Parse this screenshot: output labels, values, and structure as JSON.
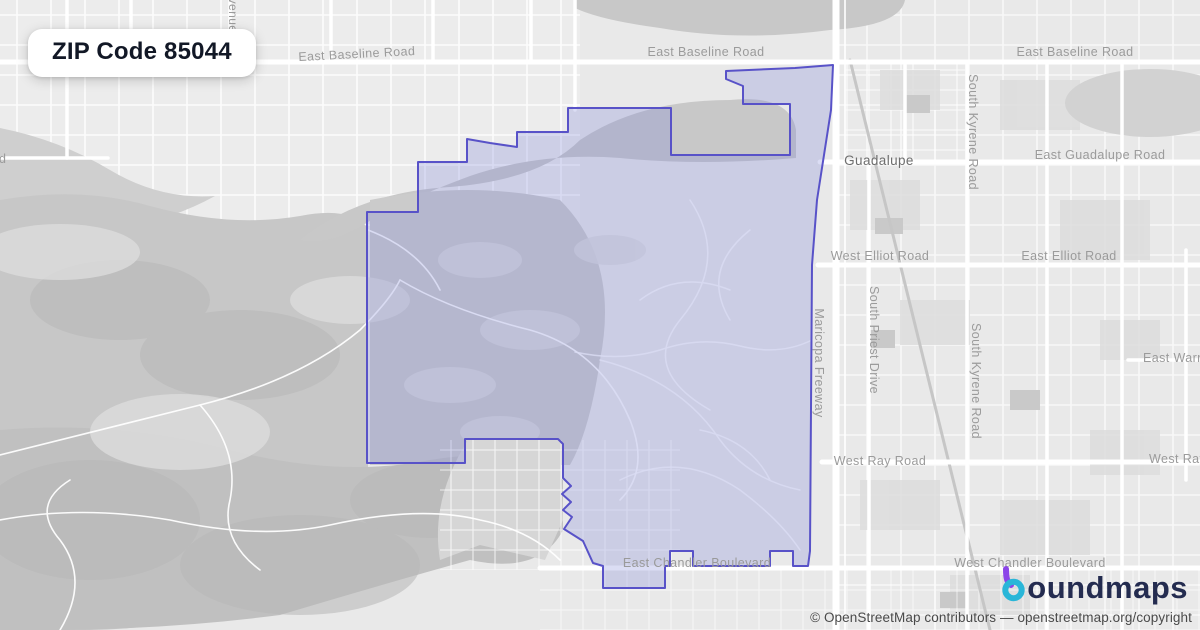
{
  "badge": {
    "title": "ZIP Code 85044"
  },
  "map": {
    "labels": [
      {
        "name": "road-label-east-baseline-road-west",
        "text": "East Baseline Road",
        "x": 357,
        "y": 58,
        "rotate": -3,
        "size": 12.5,
        "color": "#9b9b9b",
        "anchor": "middle"
      },
      {
        "name": "road-label-east-baseline-road-mid",
        "text": "East Baseline Road",
        "x": 706,
        "y": 56,
        "rotate": 0,
        "size": 12.5,
        "color": "#9b9b9b",
        "anchor": "middle"
      },
      {
        "name": "road-label-east-baseline-road-east",
        "text": "East Baseline Road",
        "x": 1075,
        "y": 56,
        "rotate": 0,
        "size": 12.5,
        "color": "#9b9b9b",
        "anchor": "middle"
      },
      {
        "name": "place-label-guadalupe",
        "text": "Guadalupe",
        "x": 879,
        "y": 165,
        "rotate": 0,
        "size": 13.5,
        "color": "#6e6e6e",
        "anchor": "middle"
      },
      {
        "name": "road-label-east-guadalupe-road",
        "text": "East Guadalupe Road",
        "x": 1100,
        "y": 159,
        "rotate": 0,
        "size": 12.5,
        "color": "#9b9b9b",
        "anchor": "middle"
      },
      {
        "name": "road-label-west-elliot-road",
        "text": "West Elliot Road",
        "x": 880,
        "y": 260,
        "rotate": 0,
        "size": 12.5,
        "color": "#9b9b9b",
        "anchor": "middle"
      },
      {
        "name": "road-label-east-elliot-road",
        "text": "East Elliot Road",
        "x": 1069,
        "y": 260,
        "rotate": 0,
        "size": 12.5,
        "color": "#9b9b9b",
        "anchor": "middle"
      },
      {
        "name": "road-label-maricopa-freeway",
        "text": "Maricopa Freeway",
        "x": 815,
        "y": 363,
        "rotate": 90,
        "size": 12.5,
        "color": "#9b9b9b",
        "anchor": "middle"
      },
      {
        "name": "road-label-south-priest-drive",
        "text": "South Priest Drive",
        "x": 870,
        "y": 340,
        "rotate": 90,
        "size": 12.5,
        "color": "#9b9b9b",
        "anchor": "middle"
      },
      {
        "name": "road-label-south-kyrene-road-north",
        "text": "South Kyrene Road",
        "x": 969,
        "y": 132,
        "rotate": 90,
        "size": 12.5,
        "color": "#9b9b9b",
        "anchor": "middle"
      },
      {
        "name": "road-label-south-kyrene-road-south",
        "text": "South Kyrene Road",
        "x": 972,
        "y": 381,
        "rotate": 90,
        "size": 12.5,
        "color": "#9b9b9b",
        "anchor": "middle"
      },
      {
        "name": "road-label-east-warner-clipped",
        "text": "East Warner Road",
        "x": 1143,
        "y": 362,
        "rotate": 0,
        "size": 12.5,
        "color": "#9b9b9b",
        "anchor": "start"
      },
      {
        "name": "road-label-west-ray-road",
        "text": "West Ray Road",
        "x": 880,
        "y": 465,
        "rotate": 0,
        "size": 12.5,
        "color": "#9b9b9b",
        "anchor": "middle"
      },
      {
        "name": "road-label-west-ray-clipped",
        "text": "West Ray Road",
        "x": 1149,
        "y": 463,
        "rotate": 0,
        "size": 12.5,
        "color": "#9b9b9b",
        "anchor": "start"
      },
      {
        "name": "road-label-east-chandler-boulevard",
        "text": "East Chandler Boulevard",
        "x": 697,
        "y": 567,
        "rotate": 0,
        "size": 12.5,
        "color": "#9a9a9a",
        "anchor": "middle"
      },
      {
        "name": "road-label-west-chandler-boulevard",
        "text": "West Chandler Boulevard",
        "x": 1030,
        "y": 567,
        "rotate": 0,
        "size": 12.5,
        "color": "#9b9b9b",
        "anchor": "middle"
      },
      {
        "name": "road-label-avenue-fragment",
        "text": "venue",
        "x": 229,
        "y": 15,
        "rotate": 90,
        "size": 12,
        "color": "#9b9b9b",
        "anchor": "middle"
      },
      {
        "name": "road-label-road-fragment",
        "text": "d",
        "x": -1,
        "y": 163,
        "rotate": 0,
        "size": 12.5,
        "color": "#9b9b9b",
        "anchor": "start"
      }
    ]
  },
  "boundary": {
    "label": "ZIP Code 85044 boundary",
    "stroke": "#5852c8",
    "fill": "rgba(125,132,215,0.28)"
  },
  "logo": {
    "name": "boundmaps",
    "visible_rest": "oundmaps",
    "purple": "#8b45e8",
    "teal": "#29b6d8"
  },
  "attribution": {
    "text": "© OpenStreetMap contributors — openstreetmap.org/copyright"
  }
}
